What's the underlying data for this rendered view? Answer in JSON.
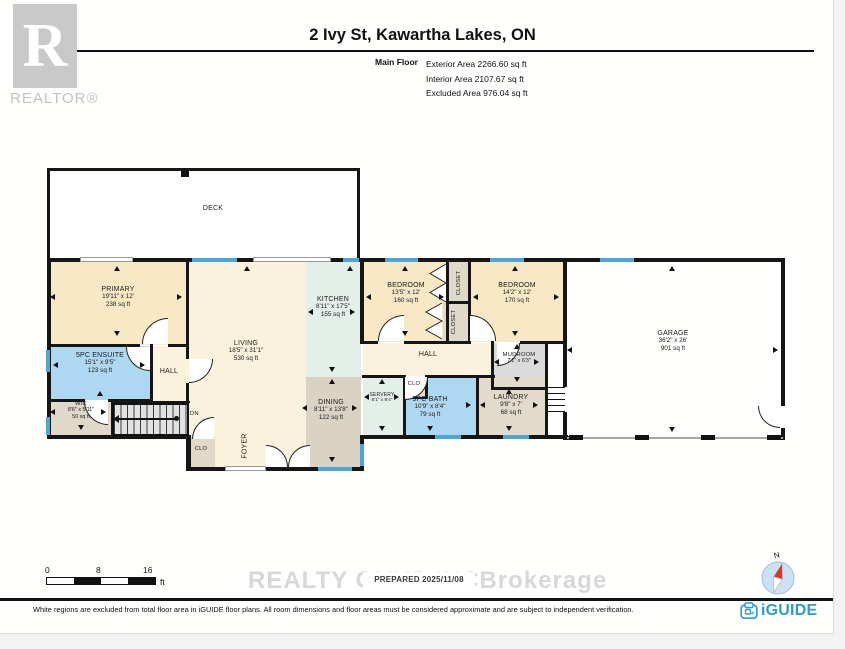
{
  "header": {
    "logo_letter": "R",
    "logo_text": "REALTOR®",
    "title": "2 Ivy St, Kawartha Lakes, ON",
    "floor_label": "Main Floor",
    "stats": [
      "Exterior Area 2266.60 sq ft",
      "Interior Area 2107.67 sq ft",
      "Excluded Area 976.04 sq ft"
    ]
  },
  "rooms": {
    "deck": {
      "name": "DECK"
    },
    "primary": {
      "name": "PRIMARY",
      "dims": "19'11\" x 12'",
      "area": "238 sq ft"
    },
    "ensuite": {
      "name": "5PC ENSUITE",
      "dims": "15'1\" x 9'5\"",
      "area": "123 sq ft"
    },
    "hall_small": {
      "name": "HALL"
    },
    "wic": {
      "name": "WIC",
      "dims": "8'6\" x 5'11\"",
      "area": "50 sq ft"
    },
    "stairs": {
      "name": "DN"
    },
    "living": {
      "name": "LIVING",
      "dims": "18'5\" x 31'1\"",
      "area": "530 sq ft"
    },
    "kitchen": {
      "name": "KITCHEN",
      "dims": "8'11\" x 17'5\"",
      "area": "155 sq ft"
    },
    "dining": {
      "name": "DINING",
      "dims": "8'11\" x 13'8\"",
      "area": "122 sq ft"
    },
    "foyer": {
      "name": "FOYER"
    },
    "clo_foyer": {
      "name": "CLO"
    },
    "bedroom1": {
      "name": "BEDROOM",
      "dims": "13'5\" x 12'",
      "area": "160 sq ft"
    },
    "closet_a": {
      "name": "CLOSET"
    },
    "closet_b": {
      "name": "CLOSET"
    },
    "bedroom2": {
      "name": "BEDROOM",
      "dims": "14'2\" x 12'",
      "area": "170 sq ft"
    },
    "hall_main": {
      "name": "HALL"
    },
    "mudroom": {
      "name": "MUDROOM",
      "dims": "7'1\" x 6'3\""
    },
    "servery": {
      "name": "SERVERY",
      "dims": "6'1\" x 8'4\""
    },
    "clo_servery": {
      "name": "CLO"
    },
    "bath": {
      "name": "5PC BATH",
      "dims": "10'9\" x 8'4\"",
      "area": "79 sq ft"
    },
    "laundry": {
      "name": "LAUNDRY",
      "dims": "9'8\" x 7'",
      "area": "68 sq ft"
    },
    "garage": {
      "name": "GARAGE",
      "dims": "36'2\" x 26'",
      "area": "901 sq ft"
    }
  },
  "scale_bar": {
    "ticks": [
      "0",
      "8",
      "16"
    ],
    "unit": "ft"
  },
  "compass": {
    "north_label": "N"
  },
  "watermark": {
    "left": "REALTY GUYS INC",
    "right": "Brokerage"
  },
  "prepared_label": "PREPARED 2025/11/08",
  "footer": {
    "disclaimer": "White regions are excluded from total floor area in iGUIDE floor plans. All room dimensions and floor areas must be considered approximate and are subject to independent verification.",
    "brand": "iGUIDE"
  },
  "colors": {
    "room_tan": "#F8E8C5",
    "room_cream": "#FAF2DC",
    "room_blue": "#AED7F2",
    "room_teal": "#E4EFE9",
    "room_taupe": "#E0D8C9",
    "room_dining": "#DAD3C4",
    "room_laundry": "#E2DACB",
    "room_grey": "#DBDBDB",
    "window": "#4EA6D4",
    "wall": "#161616",
    "brand": "#2D9CCB"
  }
}
